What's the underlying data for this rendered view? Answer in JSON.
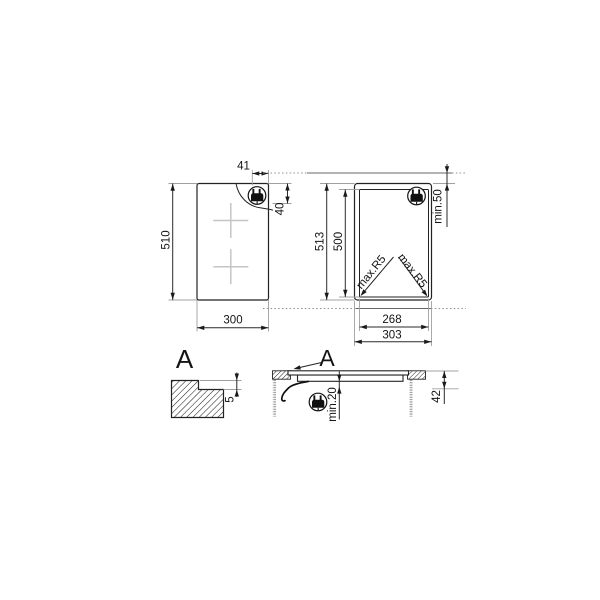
{
  "figures": {
    "top_view": {
      "height": "510",
      "width": "300",
      "plug_dist_top": "41",
      "plug_dist_side": "40"
    },
    "cutout_view": {
      "overall_height": "513",
      "cutout_height": "500",
      "cutout_width": "268",
      "overall_width": "303",
      "wall_clearance": "min.50",
      "corner_radius_left": "max.R5",
      "corner_radius_right": "max.R5"
    },
    "edge_detail": {
      "label": "A",
      "recess_depth": "5"
    },
    "section_view": {
      "label": "A",
      "bottom_clearance": "min.20",
      "built_in_depth": "42"
    }
  },
  "icons": {
    "plug": "power-plug-icon"
  },
  "colors": {
    "line": "#222222",
    "dimension": "#2a2a2a",
    "extension": "#a0a0a0",
    "burner_cross": "#c5c5c5",
    "background": "#ffffff"
  }
}
